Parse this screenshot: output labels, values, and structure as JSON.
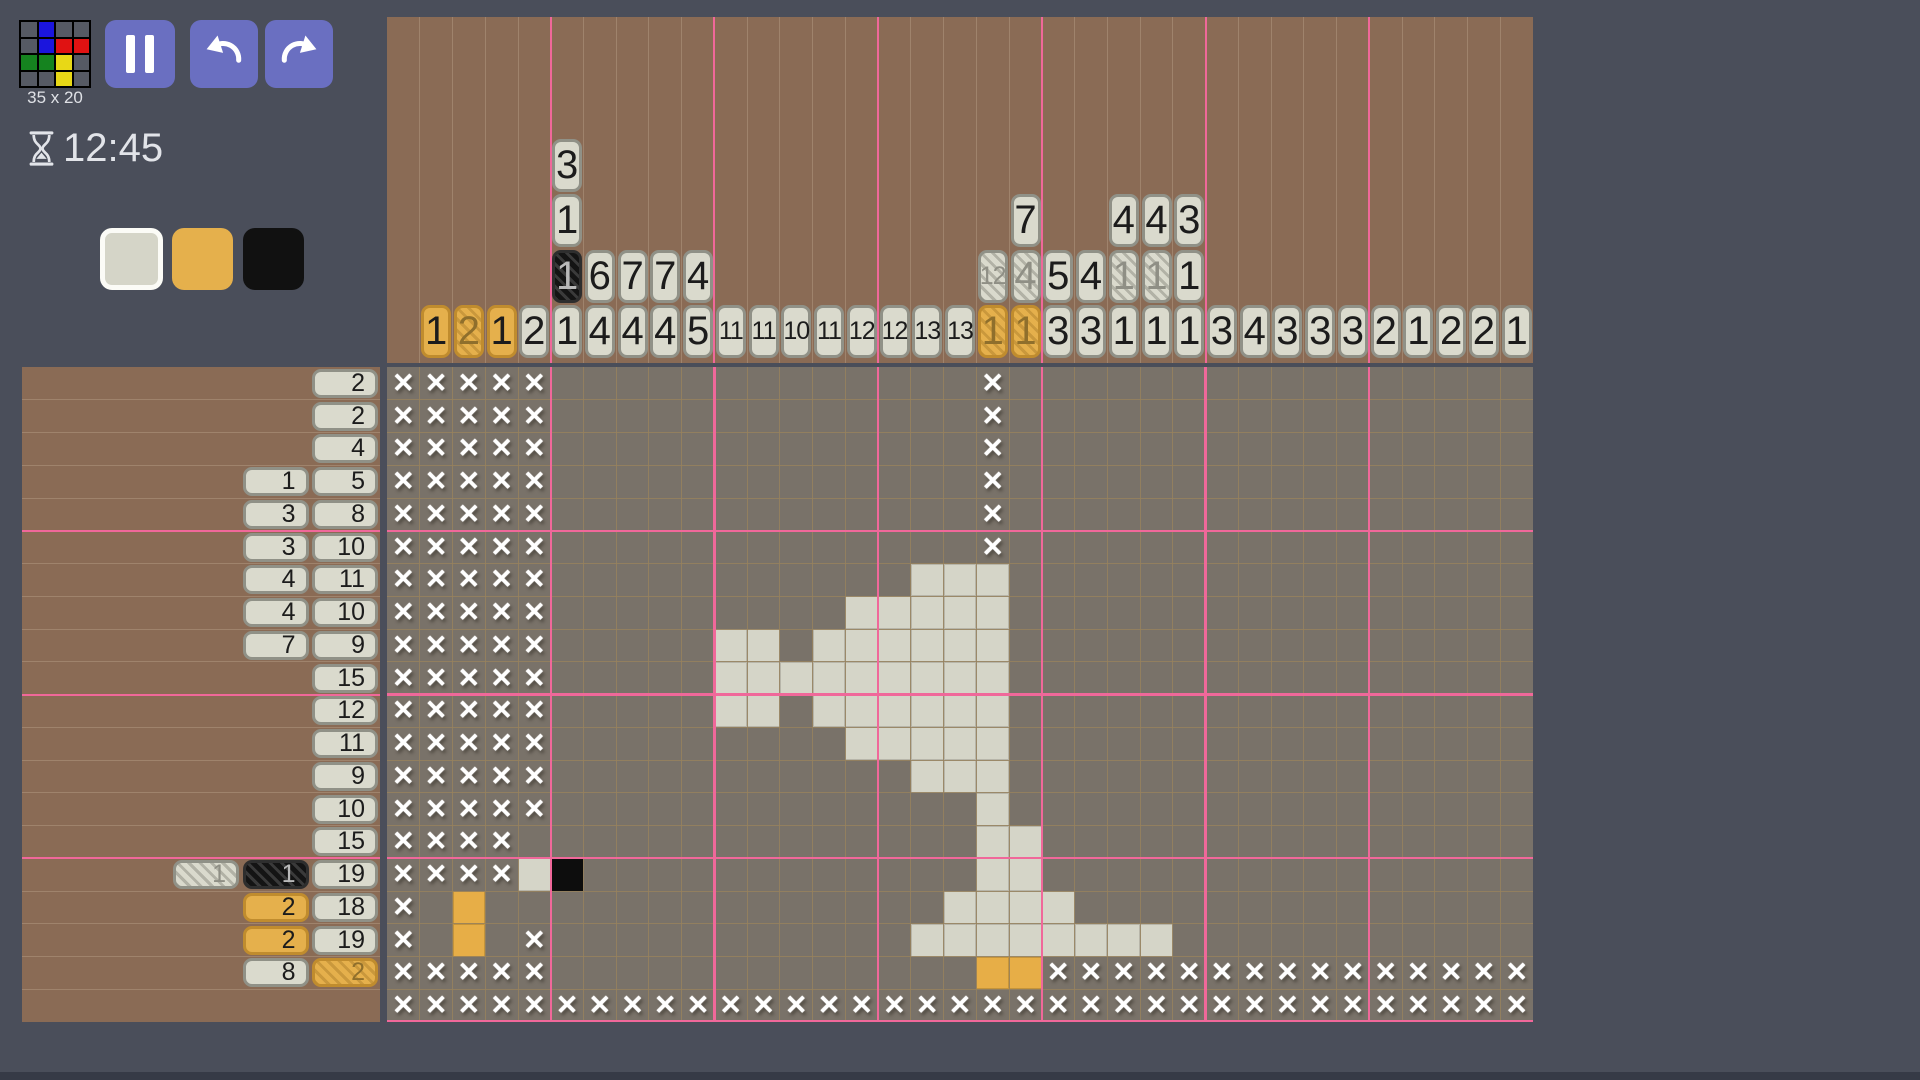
{
  "header": {
    "size_label": "35 x 20",
    "timer": "12:45"
  },
  "toolbar": {
    "buttons": [
      "pause",
      "undo",
      "redo"
    ]
  },
  "palette": [
    {
      "name": "white",
      "color": "#d5d5c8",
      "selected": true
    },
    {
      "name": "orange",
      "color": "#e5b04c",
      "selected": false
    },
    {
      "name": "black",
      "color": "#111111",
      "selected": false
    }
  ],
  "colors": {
    "page_bg": "#4a4e5a",
    "panel_brown": "#8a6b55",
    "grid_bg": "#797269",
    "grid_line": "rgba(150,129,94,0.85)",
    "panel_line": "rgba(215,195,170,0.28)",
    "accent_pink": "#f0689a",
    "button_indigo": "#6a6fc1",
    "fill_white": "#d5d5c8",
    "fill_orange": "#e7ae47",
    "fill_black": "#0d0d0d"
  },
  "logo": {
    "palette": {
      "g": "#565a64",
      "u": "#1b15dd",
      "r": "#e01212",
      "e": "#15831f",
      "y": "#e8d816"
    },
    "pixels": [
      [
        "g",
        "u",
        "g",
        "g"
      ],
      [
        "g",
        "u",
        "r",
        "r"
      ],
      [
        "e",
        "e",
        "y",
        "g"
      ],
      [
        "g",
        "g",
        "y",
        "g"
      ]
    ]
  },
  "puzzle": {
    "cols": 35,
    "rows": 20,
    "col_clues": [
      [],
      [
        [
          1,
          "o"
        ]
      ],
      [
        [
          2,
          "o",
          true
        ]
      ],
      [
        [
          1,
          "o"
        ]
      ],
      [
        [
          2,
          "w"
        ]
      ],
      [
        [
          3,
          "w"
        ],
        [
          1,
          "w"
        ],
        [
          1,
          "b",
          true
        ],
        [
          1,
          "w"
        ]
      ],
      [
        [
          6,
          "w"
        ],
        [
          4,
          "w"
        ]
      ],
      [
        [
          7,
          "w"
        ],
        [
          4,
          "w"
        ]
      ],
      [
        [
          7,
          "w"
        ],
        [
          4,
          "w"
        ]
      ],
      [
        [
          4,
          "w"
        ],
        [
          5,
          "w"
        ]
      ],
      [
        [
          11,
          "w"
        ]
      ],
      [
        [
          11,
          "w"
        ]
      ],
      [
        [
          10,
          "w"
        ]
      ],
      [
        [
          11,
          "w"
        ]
      ],
      [
        [
          12,
          "w"
        ]
      ],
      [
        [
          12,
          "w"
        ]
      ],
      [
        [
          13,
          "w"
        ]
      ],
      [
        [
          13,
          "w"
        ]
      ],
      [
        [
          12,
          "w",
          true
        ],
        [
          1,
          "o",
          true
        ]
      ],
      [
        [
          7,
          "w"
        ],
        [
          4,
          "w",
          true
        ],
        [
          1,
          "o",
          true
        ]
      ],
      [
        [
          5,
          "w"
        ],
        [
          3,
          "w"
        ]
      ],
      [
        [
          4,
          "w"
        ],
        [
          3,
          "w"
        ]
      ],
      [
        [
          4,
          "w"
        ],
        [
          1,
          "w",
          true
        ],
        [
          1,
          "w"
        ]
      ],
      [
        [
          4,
          "w"
        ],
        [
          1,
          "w",
          true
        ],
        [
          1,
          "w"
        ]
      ],
      [
        [
          3,
          "w"
        ],
        [
          1,
          "w"
        ],
        [
          1,
          "w"
        ]
      ],
      [
        [
          3,
          "w"
        ]
      ],
      [
        [
          4,
          "w"
        ]
      ],
      [
        [
          3,
          "w"
        ]
      ],
      [
        [
          3,
          "w"
        ]
      ],
      [
        [
          3,
          "w"
        ]
      ],
      [
        [
          2,
          "w"
        ]
      ],
      [
        [
          1,
          "w"
        ]
      ],
      [
        [
          2,
          "w"
        ]
      ],
      [
        [
          2,
          "w"
        ]
      ],
      [
        [
          1,
          "w"
        ]
      ]
    ],
    "row_clues": [
      [
        [
          2,
          "w"
        ]
      ],
      [
        [
          2,
          "w"
        ]
      ],
      [
        [
          4,
          "w"
        ]
      ],
      [
        [
          1,
          "w"
        ],
        [
          5,
          "w"
        ]
      ],
      [
        [
          3,
          "w"
        ],
        [
          8,
          "w"
        ]
      ],
      [
        [
          3,
          "w"
        ],
        [
          10,
          "w"
        ]
      ],
      [
        [
          4,
          "w"
        ],
        [
          11,
          "w"
        ]
      ],
      [
        [
          4,
          "w"
        ],
        [
          10,
          "w"
        ]
      ],
      [
        [
          7,
          "w"
        ],
        [
          9,
          "w"
        ]
      ],
      [
        [
          15,
          "w"
        ]
      ],
      [
        [
          12,
          "w"
        ]
      ],
      [
        [
          11,
          "w"
        ]
      ],
      [
        [
          9,
          "w"
        ]
      ],
      [
        [
          10,
          "w"
        ]
      ],
      [
        [
          15,
          "w"
        ]
      ],
      [
        [
          1,
          "w",
          true
        ],
        [
          1,
          "b",
          true
        ],
        [
          19,
          "w"
        ]
      ],
      [
        [
          2,
          "o"
        ],
        [
          18,
          "w"
        ]
      ],
      [
        [
          2,
          "o"
        ],
        [
          19,
          "w"
        ]
      ],
      [
        [
          8,
          "w"
        ],
        [
          2,
          "o",
          true
        ]
      ],
      []
    ],
    "grid": [
      "xxxxx.............x................",
      "xxxxx.............x................",
      "xxxxx.............x................",
      "xxxxx.............x................",
      "xxxxx.............x................",
      "xxxxx.............x................",
      "xxxxx...........www................",
      "xxxxx.........wwwww................",
      "xxxxx.....ww.wwwwww................",
      "xxxxx.....wwwwwwwww................",
      "xxxxx.....ww.wwwwww................",
      "xxxxx.........wwwww................",
      "xxxxx...........www................",
      "xxxxx.............w................",
      "xxxx..............ww...............",
      "xxxxwb............ww...............",
      "x.o..............wwww..............",
      "x.o.x...........wwwwwwww...........",
      "xxxxx.............ooxxxxxxxxxxxxxxx",
      "xxxxxxxxxxxxxxxxxxxxxxxxxxxxxxxxxxx"
    ]
  }
}
